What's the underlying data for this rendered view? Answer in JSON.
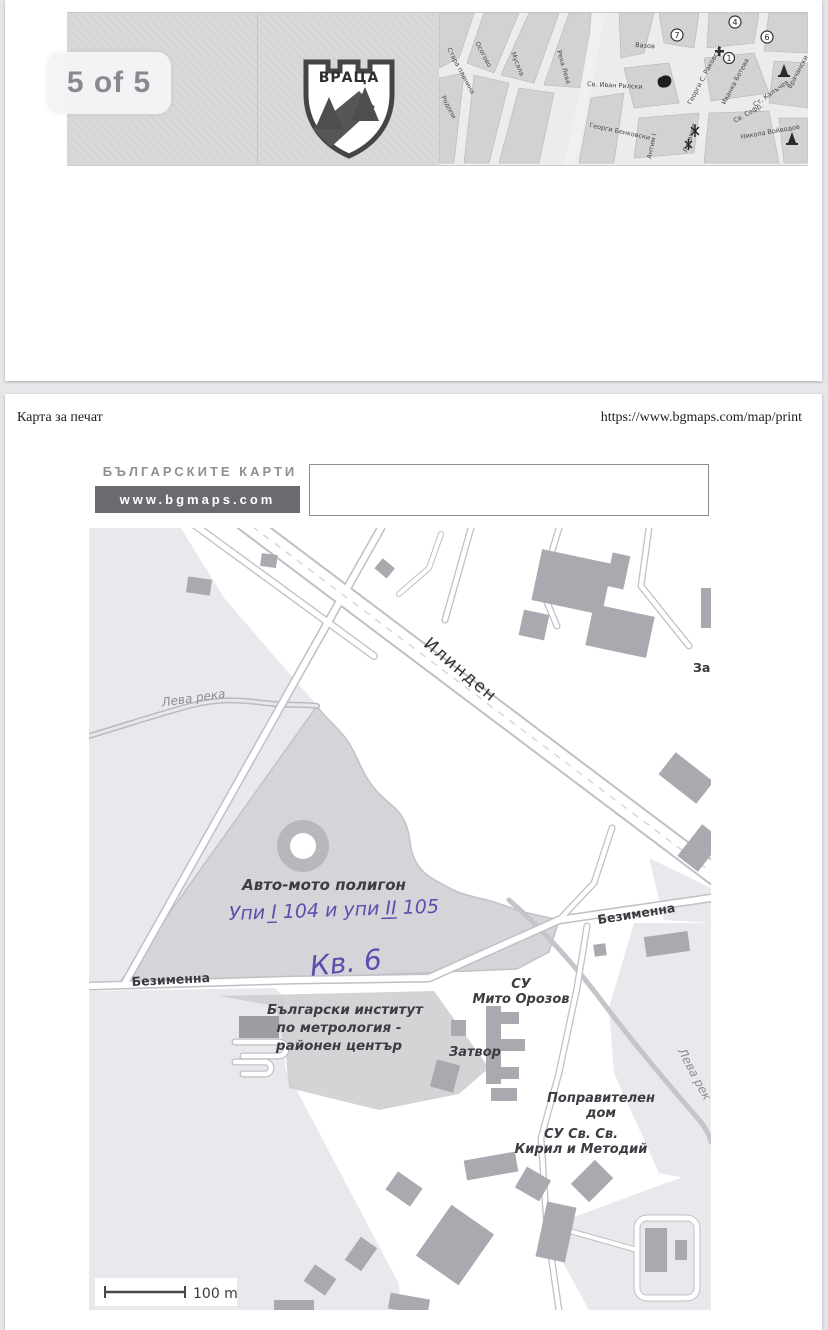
{
  "viewer": {
    "page_indicator": "5 of 5"
  },
  "colors": {
    "handwriting": "#5b4fae",
    "logo_bar": "#6a6a70",
    "map_building": "#a9a9b0",
    "map_field": "#e9e9ed",
    "map_polygon": "#d4d4d9"
  },
  "page1": {
    "crest_text": "ВРАЦА",
    "map": {
      "street_labels": [
        "Стара планина",
        "Родопи",
        "Осогово",
        "Мусала",
        "Река Лева",
        "Вазов",
        "Св. Иван Рилски",
        "Георги Бенковски",
        "Георги С. Раковски",
        "Иванка Ботева",
        "Ст. Калъчев",
        "Врачански",
        "Никола Войводов",
        "Антим I",
        "Лукашов",
        "Св. Софр."
      ],
      "markers": [
        "7",
        "4",
        "6",
        "1"
      ]
    }
  },
  "page2": {
    "header": {
      "title": "Карта за печат",
      "url": "https://www.bgmaps.com/map/print"
    },
    "logo": {
      "line1": "БЪЛГАРСКИТЕ КАРТИ",
      "line2": "www.bgmaps.com"
    },
    "search_box_value": "",
    "map": {
      "streets": {
        "ilinden": "Илинден",
        "bezimenna_west": "Безименна",
        "bezimenna_east": "Безименна"
      },
      "rivers": {
        "west": "Лева река",
        "southeast": "Лева рек"
      },
      "pois": {
        "polygon": "Авто-мото полигон",
        "institute_l1": "Български институт",
        "institute_l2": "по метрология -",
        "institute_l3": "районен център",
        "school1_l1": "СУ",
        "school1_l2": "Мито Орозов",
        "prison": "Затвор",
        "correctional_l1": "Поправителен",
        "correctional_l2": "дом",
        "school2_l1": "СУ Св. Св.",
        "school2_l2": "Кирил и Методий",
        "partial_ne": "За"
      },
      "handwriting": {
        "line1": "Упи I̲ 104 и упи I̲I̲ 105",
        "line2": "Кв. 6"
      },
      "scale_label": "100 m"
    }
  }
}
